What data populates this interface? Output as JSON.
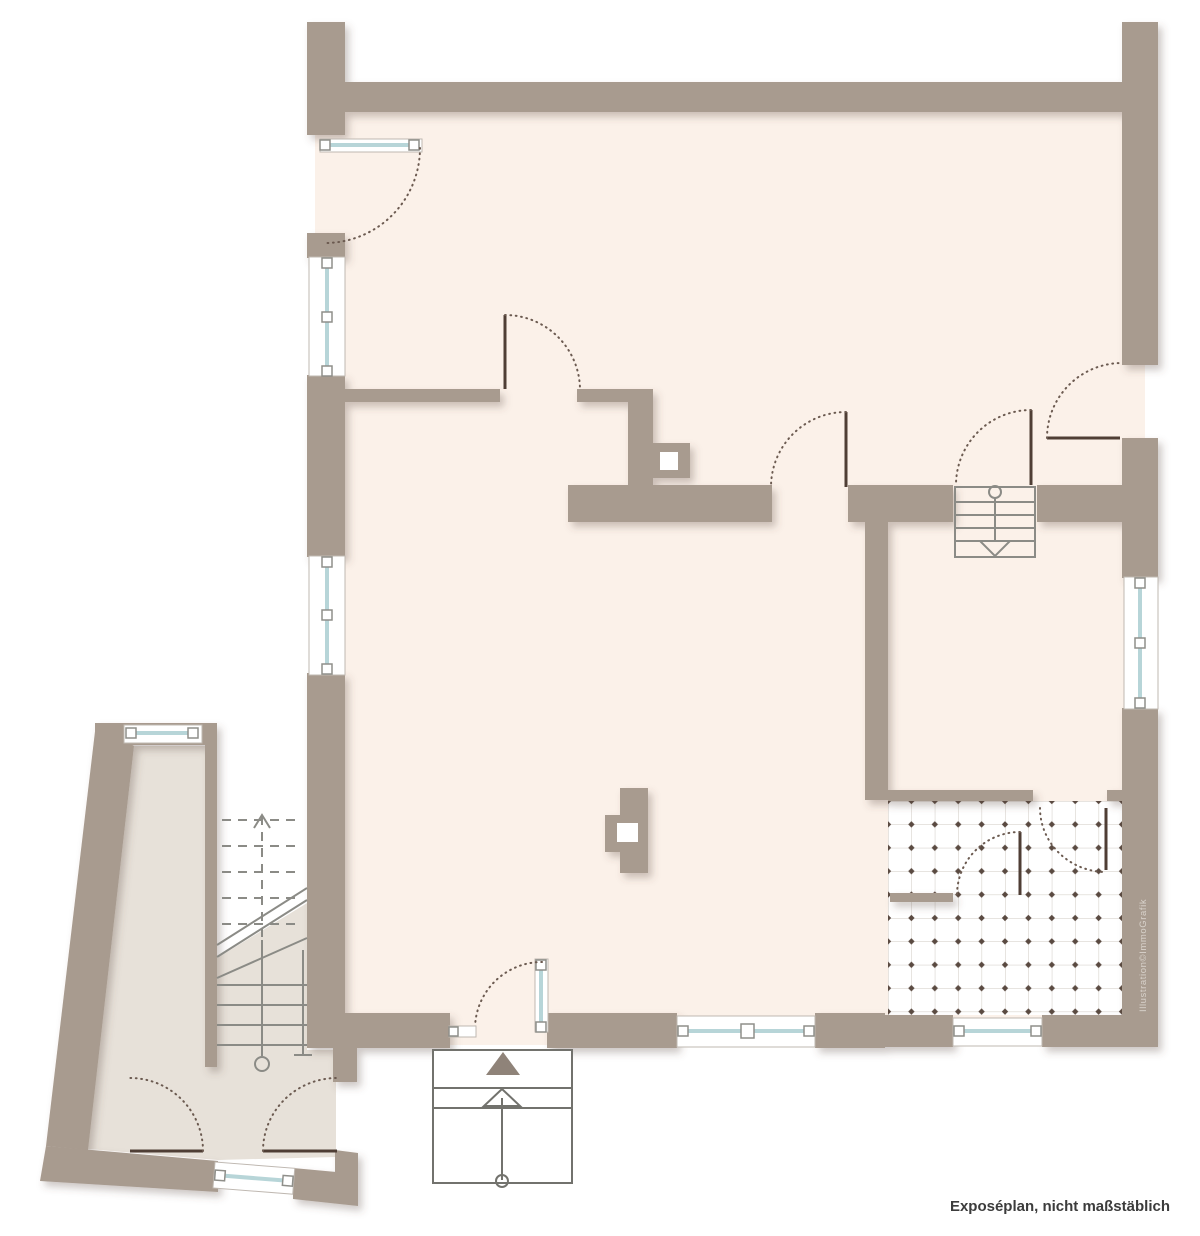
{
  "document": {
    "kind": "floor-plan-illustration",
    "footer_note": "Exposéplan, nicht maßstäblich",
    "watermark": "Illustration©ImmoGrafik"
  },
  "icons": {
    "entrance_arrow": "filled triangle pointing up at exterior steps",
    "stair_direction_main": "circle with line and arrow, downward",
    "stair_direction_basement": "circle with line and open arrow, downward"
  },
  "colors": {
    "wall": "#a89b8f",
    "floor_main": "#fbf1e9",
    "floor_annex": "#e7e1d9",
    "floor_white": "#ffffff",
    "glass": "#b7d5d8",
    "frame": "#bfb8b1",
    "square_outline": "#8f8f8a",
    "leaf": "#4f3e35",
    "arc": "#6b5a50",
    "stair": "#8b8b86",
    "steps_outline": "#72726d",
    "entry_arrow": "#8f8379",
    "tile_line": "#cfc9c2",
    "tile_dot": "#5a4a41",
    "footer_text": "#3c3c3c",
    "watermark": "#d9d3cc"
  }
}
